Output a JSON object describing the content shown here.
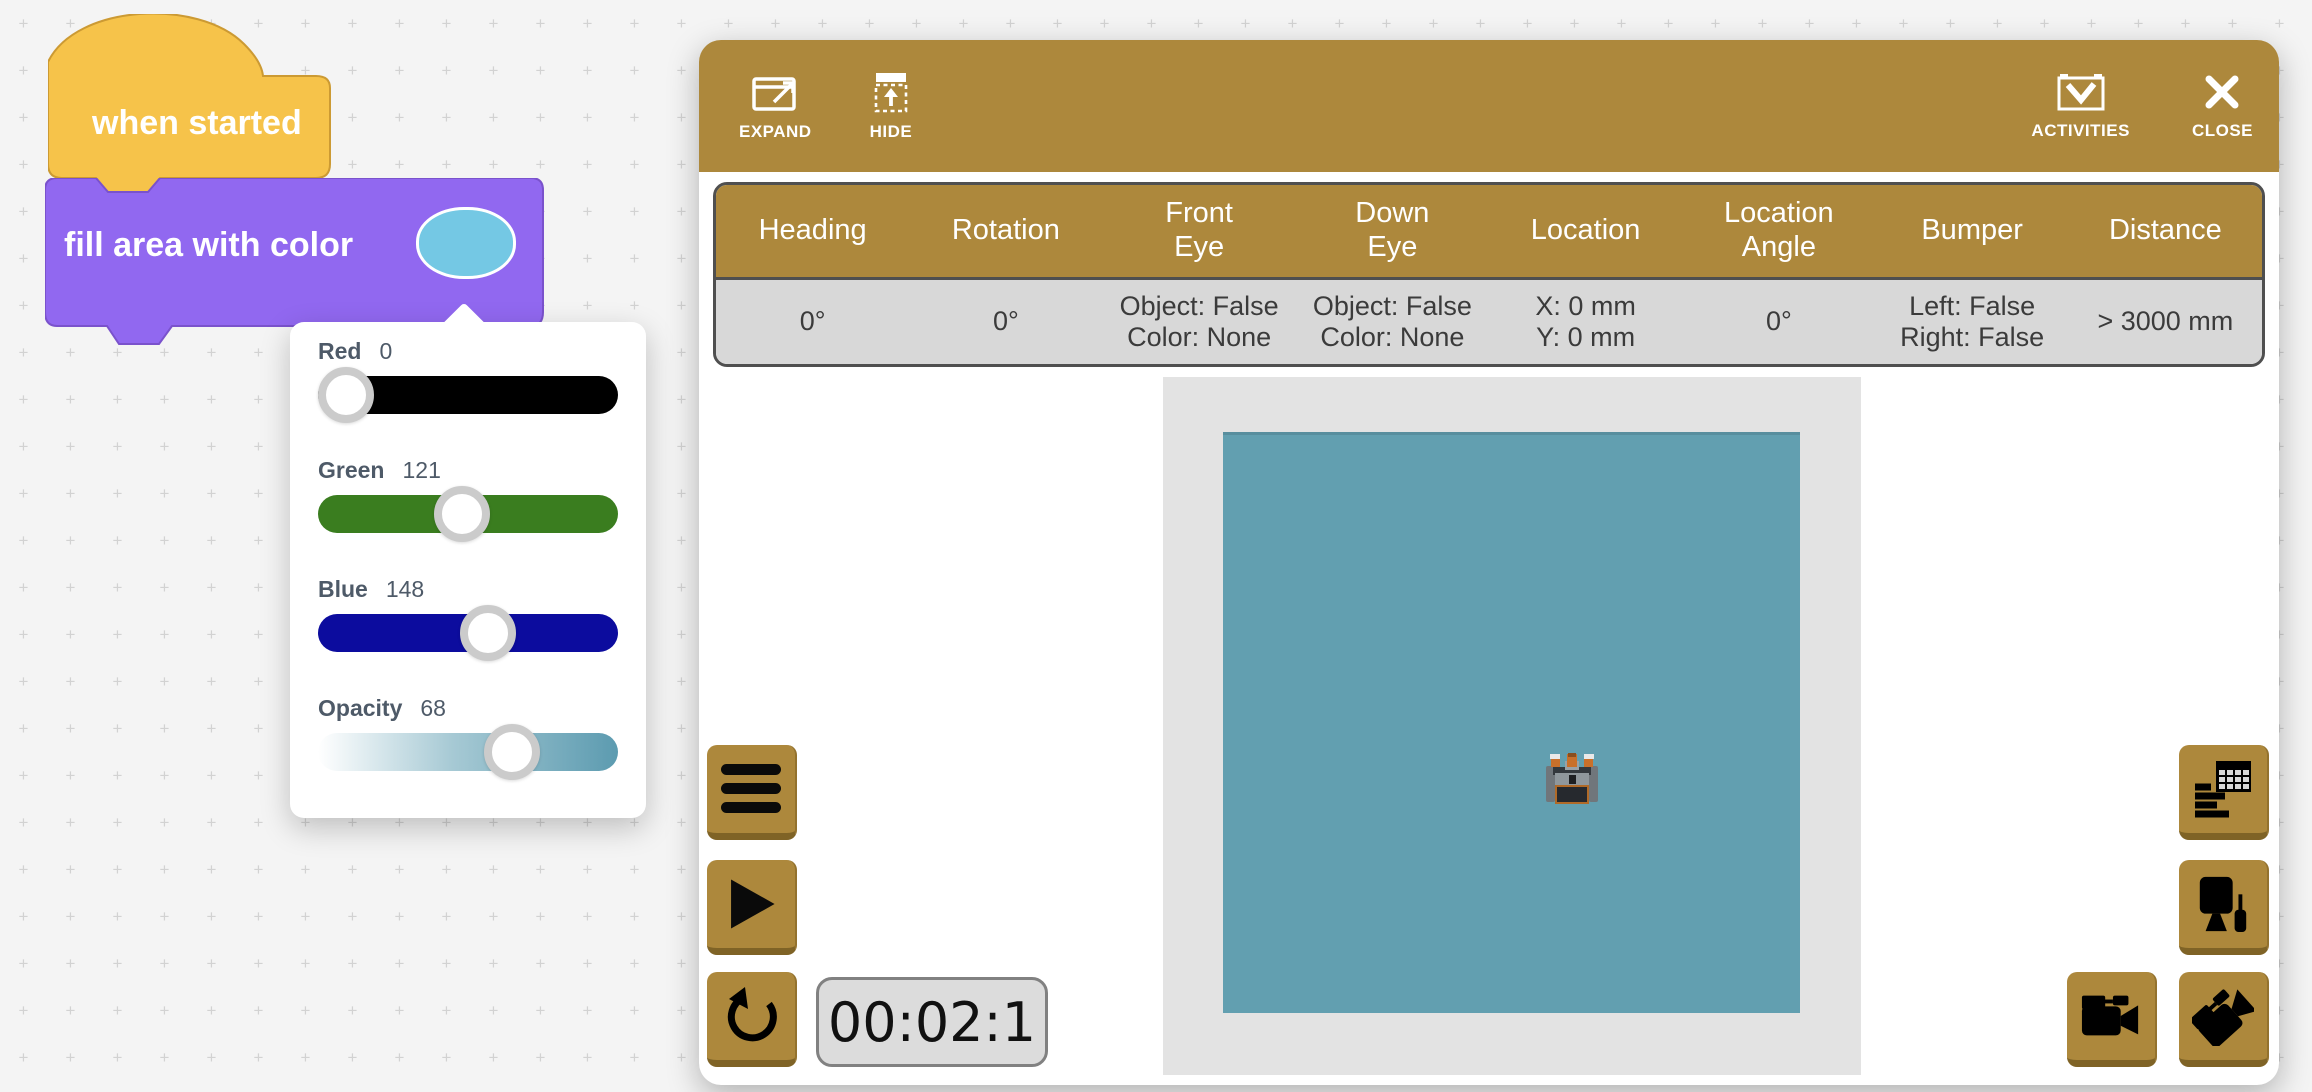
{
  "workspace": {
    "blocks": [
      {
        "type": "hat",
        "label": "when started"
      },
      {
        "type": "stack",
        "label": "fill area with color",
        "swatch_color": "#74c8e4"
      }
    ],
    "color_picker": {
      "sliders": [
        {
          "label": "Red",
          "value": 0,
          "max": 255,
          "track": "#000000"
        },
        {
          "label": "Green",
          "value": 121,
          "max": 255,
          "track": "#3a7d1f"
        },
        {
          "label": "Blue",
          "value": 148,
          "max": 255,
          "track": "#0c0c9e"
        },
        {
          "label": "Opacity",
          "value": 68,
          "max": 100,
          "track": "linear-gradient(90deg,#ffffff,#a6c9d4 45%,#5c9bb0)"
        }
      ]
    }
  },
  "panel": {
    "toolbar": {
      "expand": "EXPAND",
      "hide": "HIDE",
      "activities": "ACTIVITIES",
      "close": "CLOSE"
    },
    "sensor_table": {
      "columns": [
        [
          "Heading"
        ],
        [
          "Rotation"
        ],
        [
          "Front",
          "Eye"
        ],
        [
          "Down",
          "Eye"
        ],
        [
          "Location"
        ],
        [
          "Location",
          "Angle"
        ],
        [
          "Bumper"
        ],
        [
          "Distance"
        ]
      ],
      "values": [
        [
          "0°"
        ],
        [
          "0°"
        ],
        [
          "Object: False",
          "Color: None"
        ],
        [
          "Object: False",
          "Color: None"
        ],
        [
          "X: 0 mm",
          "Y: 0 mm"
        ],
        [
          "0°"
        ],
        [
          "Left: False",
          "Right: False"
        ],
        [
          "> 3000 mm"
        ]
      ]
    },
    "timer": "00:02:1"
  },
  "colors": {
    "brown": "#ad883c",
    "yellow": "#f6c34a",
    "purple": "#9168f0",
    "teal": "#629fb0",
    "swatch": "#74c8e4",
    "field": "#e3e3e3"
  }
}
